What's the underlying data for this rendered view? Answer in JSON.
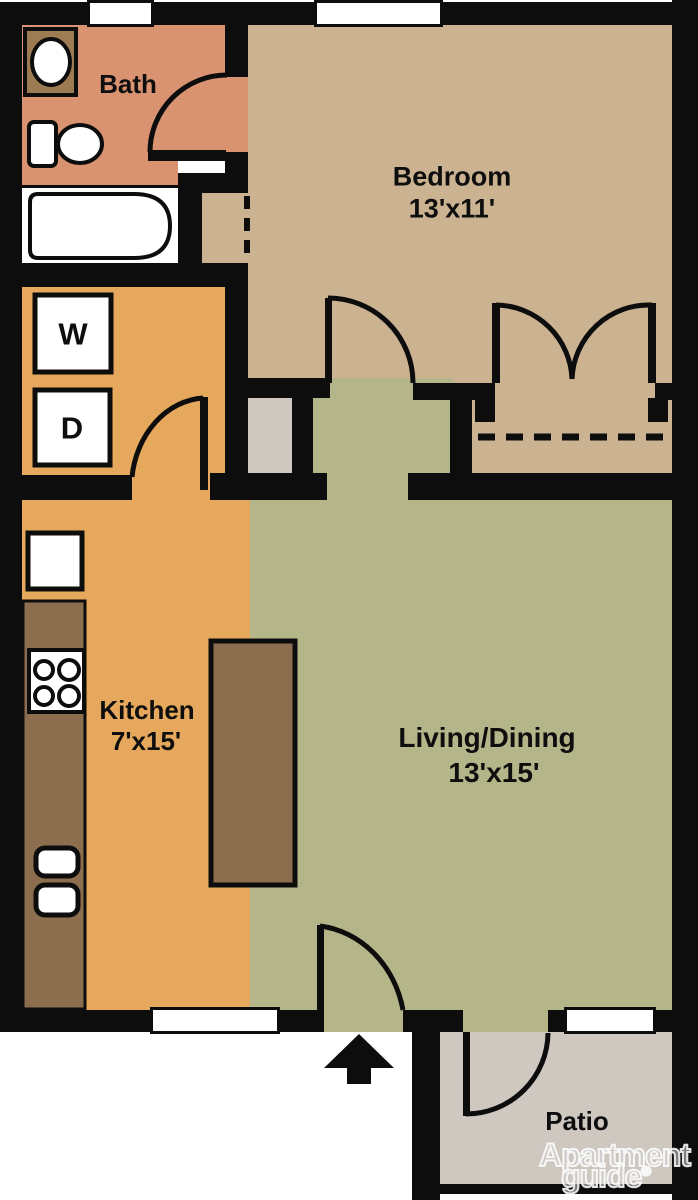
{
  "rooms": {
    "bath": {
      "label": "Bath"
    },
    "bedroom": {
      "label": "Bedroom",
      "dims": "13'x11'"
    },
    "kitchen": {
      "label": "Kitchen",
      "dims": "7'x15'"
    },
    "living": {
      "label": "Living/Dining",
      "dims": "13'x15'"
    },
    "patio": {
      "label": "Patio"
    }
  },
  "appliances": {
    "washer_label": "W",
    "dryer_label": "D"
  },
  "watermark": {
    "line1": "Apartment",
    "line2": "guide",
    "registered": "®"
  },
  "colors": {
    "wall": "#0d0d0d",
    "bath": "#d99370",
    "bedroom": "#cbb290",
    "kitchen": "#e5a85c",
    "living": "#b5b58a",
    "gray": "#cec8c1",
    "counter": "#8c6d4d",
    "vanity": "#9d7c53",
    "fixture_white": "#ffffff"
  },
  "fixtures": [
    "bathroom-sink",
    "toilet",
    "bathtub",
    "washer",
    "dryer",
    "refrigerator",
    "stove",
    "kitchen-sink",
    "kitchen-island",
    "entry-arrow"
  ],
  "doors": [
    "bath-door",
    "bedroom-door",
    "bedroom-closet-double-door",
    "laundry-door",
    "entry-door",
    "patio-door"
  ]
}
